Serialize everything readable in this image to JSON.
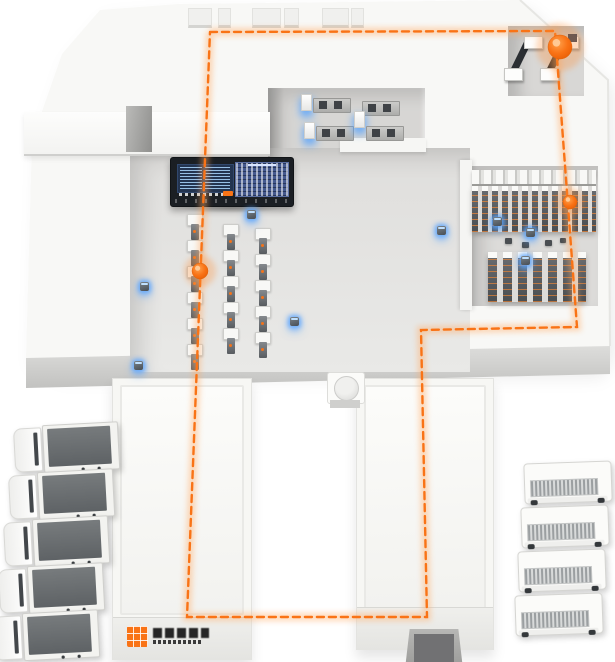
{
  "meta": {
    "scene": "smart-warehouse-3d-illustration"
  },
  "palette": {
    "accent_orange": "#f97316",
    "route_glow": "#ffab66",
    "iot_glow_blue": "#5aa5ff",
    "floor_gray": "#e4e3e1",
    "roof_white": "#f8f8f6",
    "screen_blue": "#45598e",
    "board_dark": "#1b1f24"
  },
  "route": {
    "color": "#f97316",
    "dash": "7 5",
    "width": 2.4,
    "points": "210,32 555,31 577,327 421,330 427,617 187,617 210,32",
    "markers": [
      {
        "x": 560,
        "y": 47,
        "r": 12
      },
      {
        "x": 570,
        "y": 202,
        "r": 7
      },
      {
        "x": 200,
        "y": 271,
        "r": 8
      }
    ]
  },
  "iot_dots": [
    {
      "x": 144,
      "y": 286
    },
    {
      "x": 251,
      "y": 214
    },
    {
      "x": 294,
      "y": 321
    },
    {
      "x": 138,
      "y": 365
    },
    {
      "x": 441,
      "y": 230
    },
    {
      "x": 497,
      "y": 221
    },
    {
      "x": 530,
      "y": 232
    },
    {
      "x": 525,
      "y": 260
    }
  ],
  "fleet": {
    "left_truck_count": 5,
    "right_truck_count": 4
  },
  "conveyors": {
    "lines": [
      {
        "x": 186,
        "y": 214,
        "segments": 6
      },
      {
        "x": 222,
        "y": 224,
        "segments": 5
      },
      {
        "x": 254,
        "y": 228,
        "segments": 5
      }
    ]
  },
  "logo": {
    "legible": false,
    "mark": "orange-grid-square",
    "text_lines": 2
  }
}
